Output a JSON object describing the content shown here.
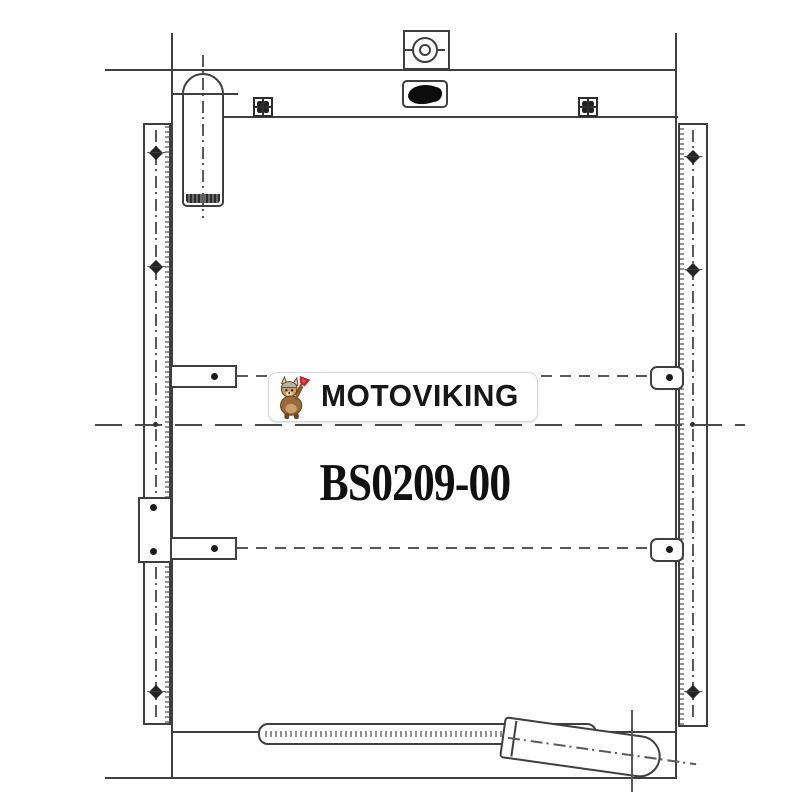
{
  "image": {
    "kind": "technical-line-drawing",
    "background": "#ffffff",
    "line_color": "#3f3f3f"
  },
  "logo": {
    "text": "MOTOVIKING",
    "icon": "viking-mascot-icon",
    "text_color": "#171717",
    "badge_background": "#ffffff",
    "badge_border": "#d9d9d9",
    "accent_red": "#c2272e",
    "mascot_brown": "#9a6a38"
  },
  "part_label": {
    "text": "BS0209-00",
    "color": "#101010"
  }
}
